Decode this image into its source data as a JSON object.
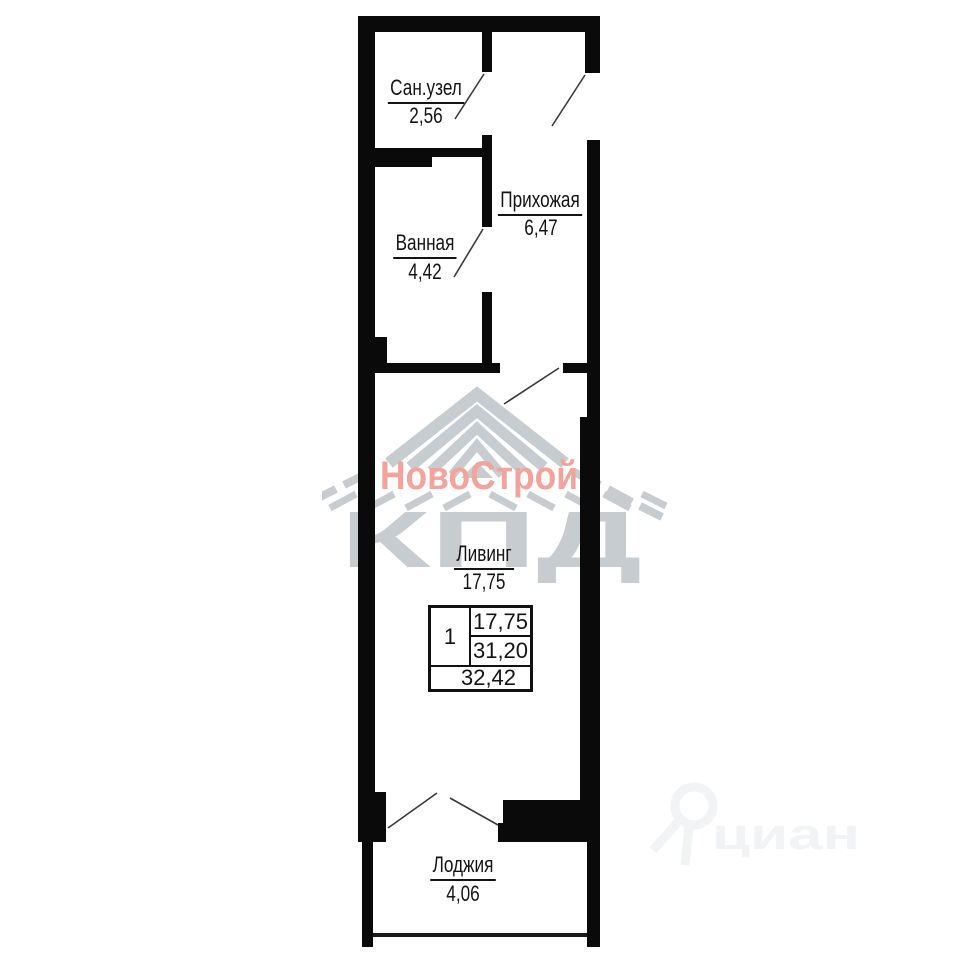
{
  "plan": {
    "rooms": [
      {
        "name": "Сан.узел",
        "area": "2,56"
      },
      {
        "name": "Ванная",
        "area": "4,42"
      },
      {
        "name": "Прихожая",
        "area": "6,47"
      },
      {
        "name": "Ливинг",
        "area": "17,75"
      },
      {
        "name": "Лоджия",
        "area": "4,06"
      }
    ],
    "summary": {
      "rooms": "1",
      "living": "17,75",
      "area": "31,20",
      "total": "32,42"
    }
  },
  "watermarks": {
    "developer_name": "НовоСтрой",
    "developer_abbr": "КПД",
    "listing_site": "циан"
  },
  "colors": {
    "wall": "#0a0a0a",
    "developer_accent": "#f2a49c",
    "developer_gray": "#c7ccd1",
    "listing_gray": "#f1f3f4"
  }
}
